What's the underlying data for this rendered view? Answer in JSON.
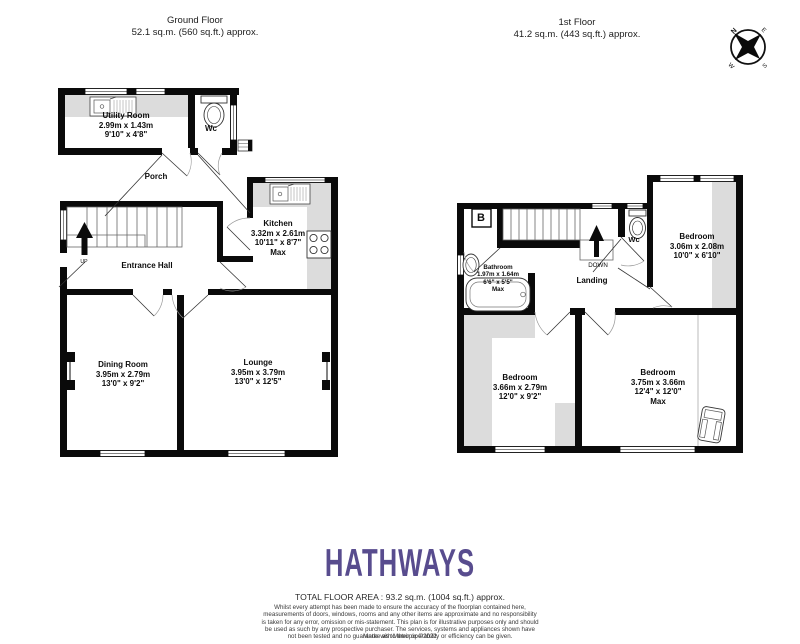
{
  "ground_floor": {
    "title": "Ground Floor",
    "area": "52.1 sq.m. (560 sq.ft.) approx.",
    "rooms": {
      "utility": {
        "name": "Utility Room",
        "dim_m": "2.99m  x 1.43m",
        "dim_ft": "9'10\"  x 4'8\""
      },
      "wc": {
        "name": "Wc"
      },
      "porch": {
        "name": "Porch"
      },
      "kitchen": {
        "name": "Kitchen",
        "dim_m": "3.32m  x 2.61m",
        "dim_ft": "10'11\"  x 8'7\"",
        "max": "Max"
      },
      "hall": {
        "name": "Entrance Hall",
        "up": "UP"
      },
      "dining": {
        "name": "Dining Room",
        "dim_m": "3.95m  x 2.79m",
        "dim_ft": "13'0\"  x 9'2\""
      },
      "lounge": {
        "name": "Lounge",
        "dim_m": "3.95m  x 3.79m",
        "dim_ft": "13'0\"  x 12'5\""
      }
    }
  },
  "first_floor": {
    "title": "1st Floor",
    "area": "41.2 sq.m. (443 sq.ft.) approx.",
    "rooms": {
      "boiler": {
        "name": "B"
      },
      "bathroom": {
        "name": "Bathroom",
        "dim_m": "1.97m  x 1.64m",
        "dim_ft": "6'6\"  x 5'5\"",
        "max": "Max"
      },
      "wc": {
        "name": "Wc"
      },
      "landing": {
        "name": "Landing",
        "down": "DOWN"
      },
      "bedroom_small": {
        "name": "Bedroom",
        "dim_m": "3.06m  x 2.08m",
        "dim_ft": "10'0\"  x 6'10\""
      },
      "bedroom_left": {
        "name": "Bedroom",
        "dim_m": "3.66m  x 2.79m",
        "dim_ft": "12'0\"  x 9'2\""
      },
      "bedroom_right": {
        "name": "Bedroom",
        "dim_m": "3.75m  x 3.66m",
        "dim_ft": "12'4\"  x 12'0\"",
        "max": "Max"
      }
    }
  },
  "compass": {
    "n": "N",
    "e": "E",
    "s": "S",
    "w": "W"
  },
  "branding": {
    "logo": "HATHWAYS",
    "logo_color": "#584C8E"
  },
  "footer": {
    "total": "TOTAL FLOOR AREA : 93.2 sq.m. (1004 sq.ft.) approx.",
    "disclaimer": "Whilst every attempt has been made to ensure the accuracy of the floorplan contained here, measurements of doors, windows, rooms and any other items are approximate and no responsibility is taken for any error, omission or mis-statement. This plan is for illustrative purposes only and should be used as such by any prospective purchaser. The services, systems and appliances shown have not been tested and no guarantee as to their operability or efficiency can be given.",
    "credit": "Made with Metropix ©2022"
  }
}
